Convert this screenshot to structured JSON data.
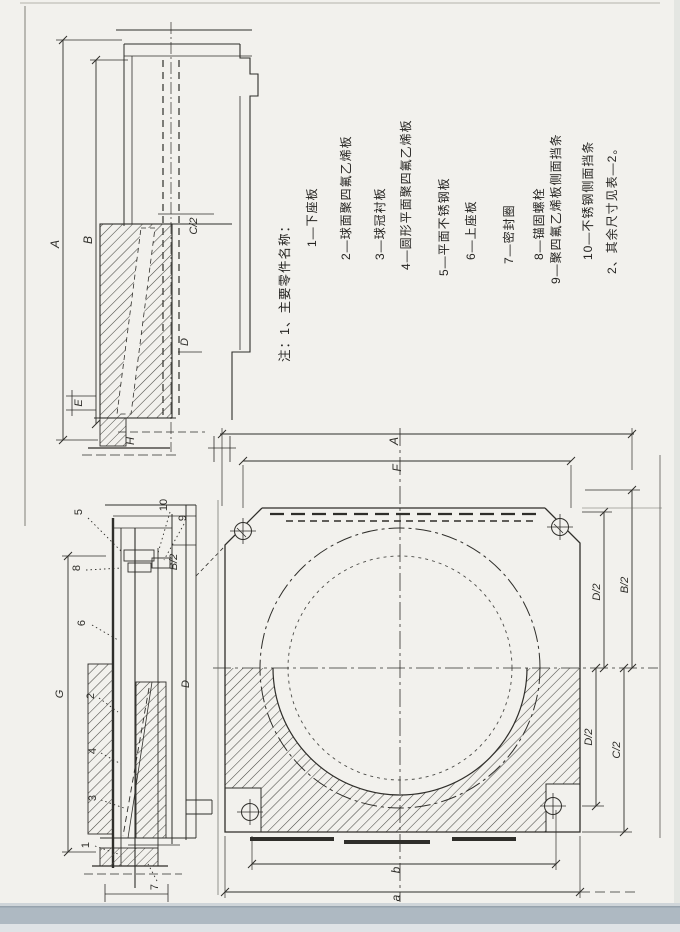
{
  "page": {
    "paper_color": "#f2f1ed",
    "ink_color": "#2f2e2a",
    "footer_band_color": "#aeb9c2"
  },
  "legend": {
    "header": "注：1、主要零件名称：",
    "items": [
      "1—下座板",
      "2—球面聚四氟乙烯板",
      "3—球冠衬板",
      "4—圆形平面聚四氟乙烯板",
      "5—平面不锈钢板",
      "6—上座板",
      "7—密封圈",
      "8—锚固螺栓",
      "9—聚四氟乙烯板侧面挡条",
      "10—不锈钢侧面挡条"
    ],
    "footnote": "2、其余尺寸见表—2。"
  },
  "upper_section_view": {
    "dims": {
      "overall_height": "A",
      "inner_height": "B",
      "half_width": "C/2",
      "plate": "D",
      "edge": "E",
      "base": "H"
    }
  },
  "lower_section_view": {
    "dims": {
      "overall": "G",
      "half_width": "B/2",
      "plate": "D"
    },
    "callouts": {
      "c1": "1",
      "c2": "2",
      "c3": "3",
      "c4": "4",
      "c5": "5",
      "c6": "6",
      "c7": "7",
      "c8": "8",
      "c9": "9",
      "c10": "10"
    }
  },
  "plan_view": {
    "dims": {
      "top_outer": "A",
      "top_inner": "F",
      "right_upper_outer": "B/2",
      "right_upper_inner": "D/2",
      "right_lower_inner": "D/2",
      "right_lower_outer": "C/2",
      "bottom_inner": "b",
      "bottom_outer": "a"
    }
  }
}
